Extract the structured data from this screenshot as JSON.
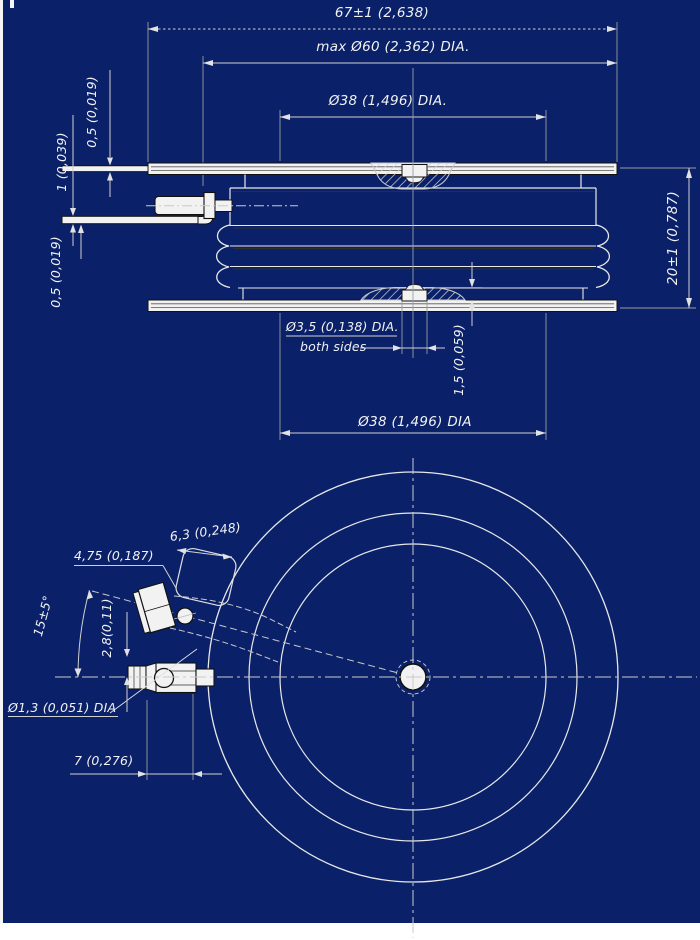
{
  "page": {
    "background_color": "#0a2169",
    "paper_color": "#ffffff",
    "line_color": "#e8e8e8",
    "fill_color": "#f2f2f2"
  },
  "side_view": {
    "dim_overall_width": "67±1 (2,638)",
    "dim_max_diameter": "max Ø60 (2,362) DIA.",
    "dim_pole_diameter_top": "Ø38 (1,496) DIA.",
    "dim_flange_thickness": "0,5 (0,019)",
    "dim_gate_lead": "1 (0,039)",
    "dim_lead_thickness": "0,5 (0,019)",
    "dim_height": "20±1 (0,787)",
    "dim_recess_diameter": "Ø3,5 (0,138) DIA.",
    "note_both_sides": "both sides",
    "dim_recess_depth": "1,5 (0,059)",
    "dim_pole_diameter_bottom": "Ø38 (1,496) DIA"
  },
  "plan_view": {
    "dim_terminal_width": "4,75 (0,187)",
    "dim_terminal_length": "6,3 (0,248)",
    "dim_gate_angle": "15±5°",
    "dim_gate_offset": "2,8(0,11)",
    "dim_hole_diameter": "Ø1,3 (0,051) DIA",
    "dim_lead_length": "7 (0,276)"
  }
}
